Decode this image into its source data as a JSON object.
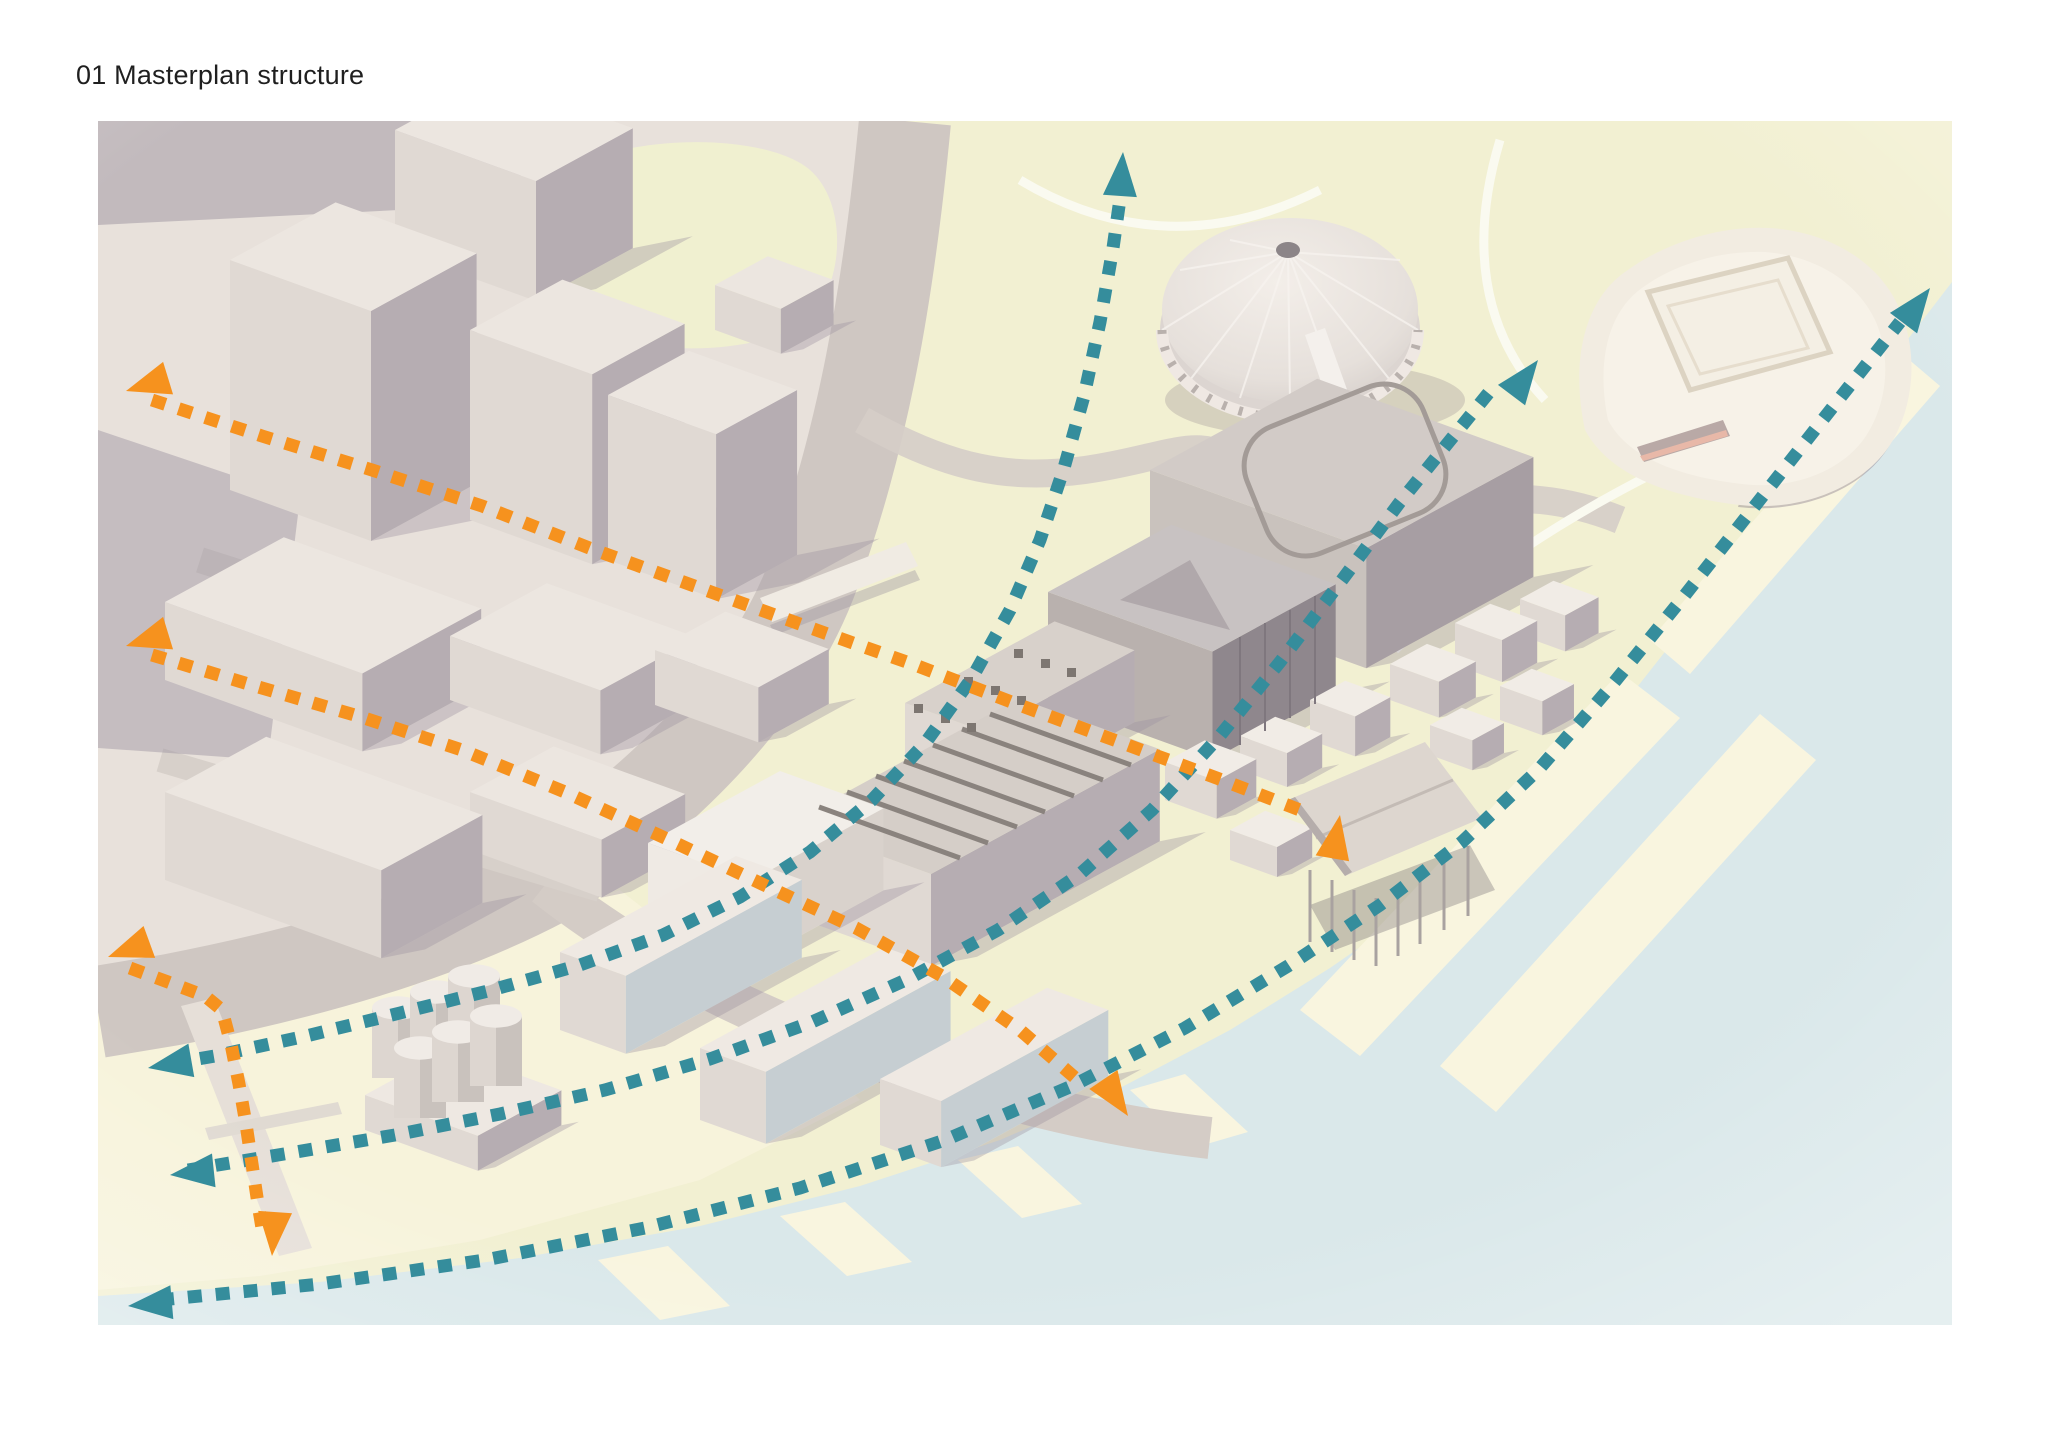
{
  "title": "01 Masterplan structure",
  "figure": {
    "alt": "Aerial axonometric rendering of a waterfront masterplan with dashed movement arrows",
    "colors": {
      "teal": "#358d9c",
      "orange": "#f6921e"
    },
    "arrows": [
      {
        "id": "road-curve-route",
        "color": "teal",
        "points": [
          [
            1123,
            178
          ],
          [
            1113,
            248
          ],
          [
            1100,
            322
          ],
          [
            1084,
            396
          ],
          [
            1064,
            468
          ],
          [
            1040,
            540
          ],
          [
            1010,
            610
          ],
          [
            972,
            678
          ],
          [
            926,
            742
          ],
          [
            872,
            800
          ],
          [
            810,
            852
          ],
          [
            740,
            897
          ],
          [
            663,
            935
          ],
          [
            580,
            965
          ],
          [
            492,
            990
          ],
          [
            400,
            1013
          ],
          [
            306,
            1036
          ],
          [
            215,
            1056
          ],
          [
            168,
            1064
          ]
        ],
        "heads": [
          [
            1123,
            152,
            86
          ],
          [
            148,
            1068,
            190
          ]
        ]
      },
      {
        "id": "site-diagonal-route",
        "color": "teal",
        "points": [
          [
            188,
            1170
          ],
          [
            290,
            1153
          ],
          [
            395,
            1135
          ],
          [
            500,
            1114
          ],
          [
            605,
            1090
          ],
          [
            710,
            1059
          ],
          [
            812,
            1022
          ],
          [
            908,
            979
          ],
          [
            998,
            930
          ],
          [
            1080,
            874
          ],
          [
            1152,
            810
          ],
          [
            1218,
            738
          ],
          [
            1280,
            662
          ],
          [
            1342,
            580
          ],
          [
            1400,
            502
          ],
          [
            1452,
            438
          ],
          [
            1495,
            385
          ]
        ],
        "heads": [
          [
            170,
            1175,
            186
          ],
          [
            1538,
            360,
            53
          ]
        ]
      },
      {
        "id": "waterfront-route",
        "color": "teal",
        "points": [
          [
            160,
            1300
          ],
          [
            320,
            1284
          ],
          [
            485,
            1260
          ],
          [
            645,
            1228
          ],
          [
            800,
            1188
          ],
          [
            945,
            1140
          ],
          [
            1072,
            1086
          ],
          [
            1185,
            1028
          ],
          [
            1288,
            966
          ],
          [
            1380,
            905
          ],
          [
            1462,
            842
          ],
          [
            1540,
            768
          ],
          [
            1612,
            685
          ],
          [
            1685,
            595
          ],
          [
            1758,
            502
          ],
          [
            1832,
            408
          ],
          [
            1900,
            322
          ]
        ],
        "heads": [
          [
            128,
            1306,
            185
          ],
          [
            1930,
            288,
            53
          ]
        ]
      },
      {
        "id": "cross-axis-north",
        "color": "orange",
        "points": [
          [
            152,
            400
          ],
          [
            262,
            436
          ],
          [
            372,
            470
          ],
          [
            482,
            506
          ],
          [
            592,
            549
          ],
          [
            700,
            588
          ],
          [
            808,
            627
          ],
          [
            915,
            665
          ],
          [
            1022,
            706
          ],
          [
            1125,
            744
          ],
          [
            1222,
            780
          ],
          [
            1300,
            810
          ]
        ],
        "heads": [
          [
            126,
            391,
            197
          ],
          [
            1340,
            815,
            80
          ]
        ]
      },
      {
        "id": "cross-axis-south",
        "color": "orange",
        "points": [
          [
            152,
            655
          ],
          [
            255,
            686
          ],
          [
            358,
            716
          ],
          [
            462,
            750
          ],
          [
            565,
            792
          ],
          [
            665,
            838
          ],
          [
            762,
            884
          ],
          [
            856,
            928
          ],
          [
            942,
            976
          ],
          [
            1020,
            1030
          ],
          [
            1080,
            1082
          ]
        ],
        "heads": [
          [
            126,
            646,
            197
          ],
          [
            1128,
            1116,
            304
          ]
        ]
      },
      {
        "id": "pier-link",
        "color": "orange",
        "points": [
          [
            130,
            968
          ],
          [
            168,
            982
          ],
          [
            205,
            996
          ],
          [
            222,
            1010
          ],
          [
            231,
            1044
          ],
          [
            239,
            1084
          ],
          [
            246,
            1124
          ],
          [
            252,
            1164
          ],
          [
            258,
            1204
          ],
          [
            263,
            1234
          ]
        ],
        "heads": [
          [
            108,
            957,
            200
          ],
          [
            272,
            1256,
            266
          ]
        ]
      }
    ]
  }
}
